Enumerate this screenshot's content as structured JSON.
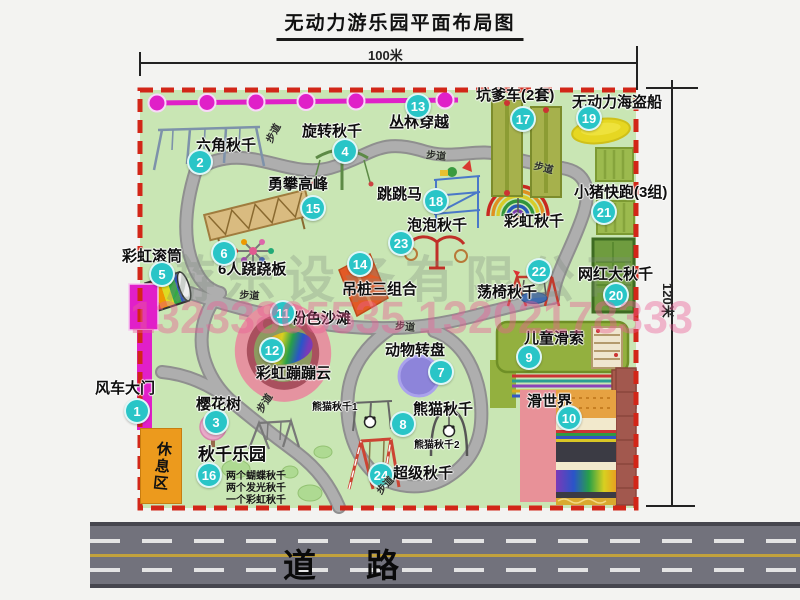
{
  "title": "无动力游乐园平面布局图",
  "dim_width": "100米",
  "dim_height": "120米",
  "road": {
    "label": "道路"
  },
  "rest_area": "休息区",
  "trail_text": "步道",
  "watermark": {
    "phone": "13233805535 13202178333",
    "company": "游乐设备有限公司"
  },
  "colors": {
    "park_fill": "#c9e6b4",
    "border_red": "#d22618",
    "path_gray": "#a8a8a8",
    "badge_cyan": "#29c5c7",
    "road_gray": "#72727c",
    "gate_magenta": "#e11fc9",
    "rest_orange": "#ec9a1d",
    "zipline_magenta": "#e020c8"
  },
  "attractions": [
    {
      "num": "1",
      "label": "风车大门",
      "badge": [
        137,
        411
      ],
      "label_pos": [
        95,
        381
      ]
    },
    {
      "num": "2",
      "label": "六角秋千",
      "badge": [
        200,
        162
      ],
      "label_pos": [
        196,
        138
      ]
    },
    {
      "num": "3",
      "label": "樱花树",
      "badge": [
        216,
        422
      ],
      "label_pos": [
        196,
        397
      ]
    },
    {
      "num": "4",
      "label": "旋转秋千",
      "badge": [
        345,
        151
      ],
      "label_pos": [
        302,
        124
      ]
    },
    {
      "num": "5",
      "label": "彩虹滚筒",
      "badge": [
        162,
        274
      ],
      "label_pos": [
        122,
        249
      ]
    },
    {
      "num": "6",
      "label": "6人跷跷板",
      "badge": [
        224,
        253
      ],
      "label_pos": [
        218,
        262
      ]
    },
    {
      "num": "7",
      "label": "动物转盘",
      "badge": [
        441,
        372
      ],
      "label_pos": [
        385,
        343
      ]
    },
    {
      "num": "8",
      "label": "熊猫秋千",
      "badge": [
        403,
        424
      ],
      "label_pos": [
        413,
        402
      ]
    },
    {
      "num": "9",
      "label": "儿童滑索",
      "badge": [
        529,
        357
      ],
      "label_pos": [
        524,
        331
      ]
    },
    {
      "num": "10",
      "label": "滑世界",
      "badge": [
        569,
        418
      ],
      "label_pos": [
        527,
        394
      ]
    },
    {
      "num": "11",
      "label": "粉色沙滩",
      "badge": [
        283,
        313
      ],
      "label_pos": [
        291,
        311
      ]
    },
    {
      "num": "12",
      "label": "彩虹蹦蹦云",
      "badge": [
        272,
        350
      ],
      "label_pos": [
        256,
        366
      ]
    },
    {
      "num": "13",
      "label": "丛林穿越",
      "badge": [
        418,
        106
      ],
      "label_pos": [
        389,
        115
      ]
    },
    {
      "num": "14",
      "label": "吊桩三组合",
      "badge": [
        360,
        264
      ],
      "label_pos": [
        342,
        282
      ]
    },
    {
      "num": "15",
      "label": "勇攀高峰",
      "badge": [
        313,
        208
      ],
      "label_pos": [
        268,
        177
      ]
    },
    {
      "num": "16",
      "label": "秋千乐园",
      "badge": [
        209,
        475
      ],
      "label_pos": [
        198,
        446
      ],
      "size": 17
    },
    {
      "num": "17",
      "label": "坑爹车(2套)",
      "badge": [
        523,
        119
      ],
      "label_pos": [
        476,
        88
      ]
    },
    {
      "num": "18",
      "label": "跳跳马",
      "badge": [
        436,
        201
      ],
      "label_pos": [
        377,
        187
      ]
    },
    {
      "num": "19",
      "label": "无动力海盗船",
      "badge": [
        589,
        118
      ],
      "label_pos": [
        572,
        95
      ]
    },
    {
      "num": "20",
      "label": "网红大秋千",
      "badge": [
        616,
        295
      ],
      "label_pos": [
        578,
        267
      ]
    },
    {
      "num": "21",
      "label": "小猪快跑(3组)",
      "badge": [
        604,
        212
      ],
      "label_pos": [
        574,
        185
      ]
    },
    {
      "num": "22",
      "label": "荡椅秋千",
      "badge": [
        539,
        271
      ],
      "label_pos": [
        477,
        285
      ]
    },
    {
      "num": "23",
      "label": "泡泡秋千",
      "badge": [
        401,
        243
      ],
      "label_pos": [
        407,
        218
      ]
    },
    {
      "num": "24",
      "label": "超级秋千",
      "badge": [
        381,
        475
      ],
      "label_pos": [
        393,
        466
      ]
    }
  ],
  "extra_labels": [
    {
      "label": "彩虹秋千",
      "pos": [
        504,
        214
      ],
      "size": 15
    },
    {
      "label": "熊猫秋千1",
      "pos": [
        312,
        403
      ],
      "size": 10
    },
    {
      "label": "熊猫秋千2",
      "pos": [
        414,
        441
      ],
      "size": 10
    }
  ],
  "swing_park_details": [
    "两个蝴蝶秋千",
    "两个发光秋千",
    "一个彩虹秋千"
  ],
  "trails": [
    {
      "pos": [
        261,
        138
      ],
      "rot": -62
    },
    {
      "pos": [
        427,
        146
      ],
      "rot": 6
    },
    {
      "pos": [
        536,
        157
      ],
      "rot": 14
    },
    {
      "pos": [
        240,
        286
      ],
      "rot": 4
    },
    {
      "pos": [
        396,
        317
      ],
      "rot": 6
    },
    {
      "pos": [
        252,
        407
      ],
      "rot": -58
    },
    {
      "pos": [
        372,
        487
      ],
      "rot": -48
    }
  ]
}
